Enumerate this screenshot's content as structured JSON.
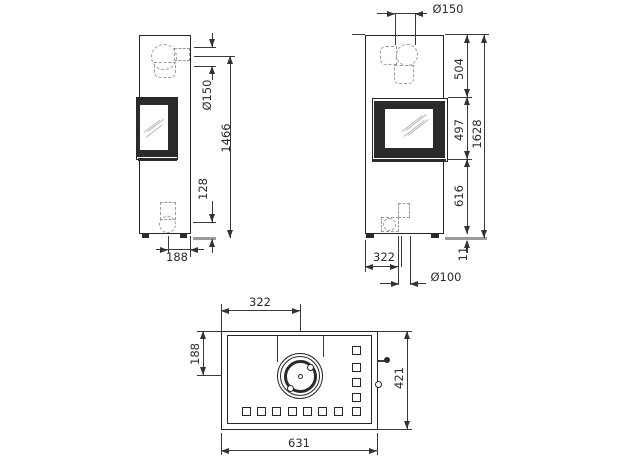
{
  "drawing": {
    "type": "stove-dimension-drawing",
    "line_color": "#2a2a2a",
    "dashed_color": "#9c9c9c",
    "floor_color": "#9a9a9a"
  },
  "dims": {
    "side_flue_dia": "Ø150",
    "side_height": "1466",
    "side_outlet_height": "128",
    "side_outlet_offset": "188",
    "front_flue_dia": "Ø150",
    "front_top_section": "504",
    "front_door_height": "497",
    "front_total_height": "1628",
    "front_lower_section": "616",
    "front_base_height": "11",
    "front_outlet_offset": "322",
    "front_outlet_dia": "Ø100",
    "top_flue_offset_x": "322",
    "top_flue_offset_y": "188",
    "top_depth": "421",
    "top_width": "631"
  }
}
